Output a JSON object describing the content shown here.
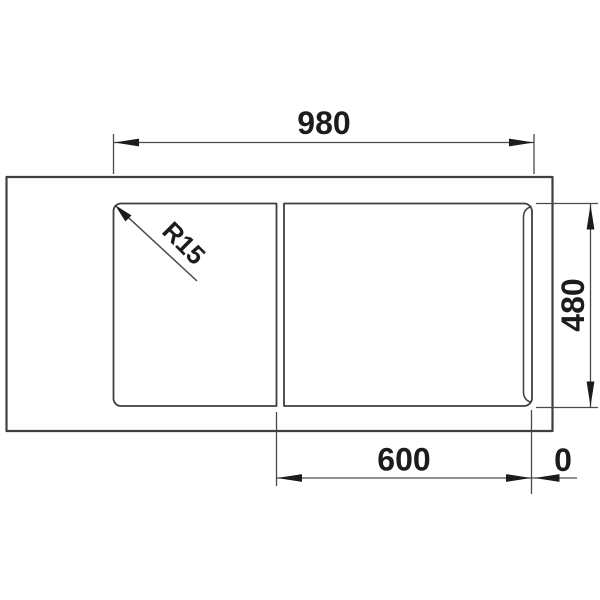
{
  "diagram": {
    "kind": "sink-installation-top-view",
    "labels": {
      "overall_width": "980",
      "depth": "480",
      "bowl_section": "600",
      "edge_offset": "0",
      "corner_radius": "R15"
    },
    "dimensions_mm": {
      "overall_width": 980,
      "depth": 480,
      "bowl_section": 600,
      "edge_offset": 0,
      "corner_radius_mm": 15
    },
    "colors": {
      "background": "#ffffff",
      "outline": "#3f3f3f",
      "dimension_line": "#4a4a4a",
      "text": "#1c1c1c",
      "arrow": "#1c1c1c"
    }
  }
}
